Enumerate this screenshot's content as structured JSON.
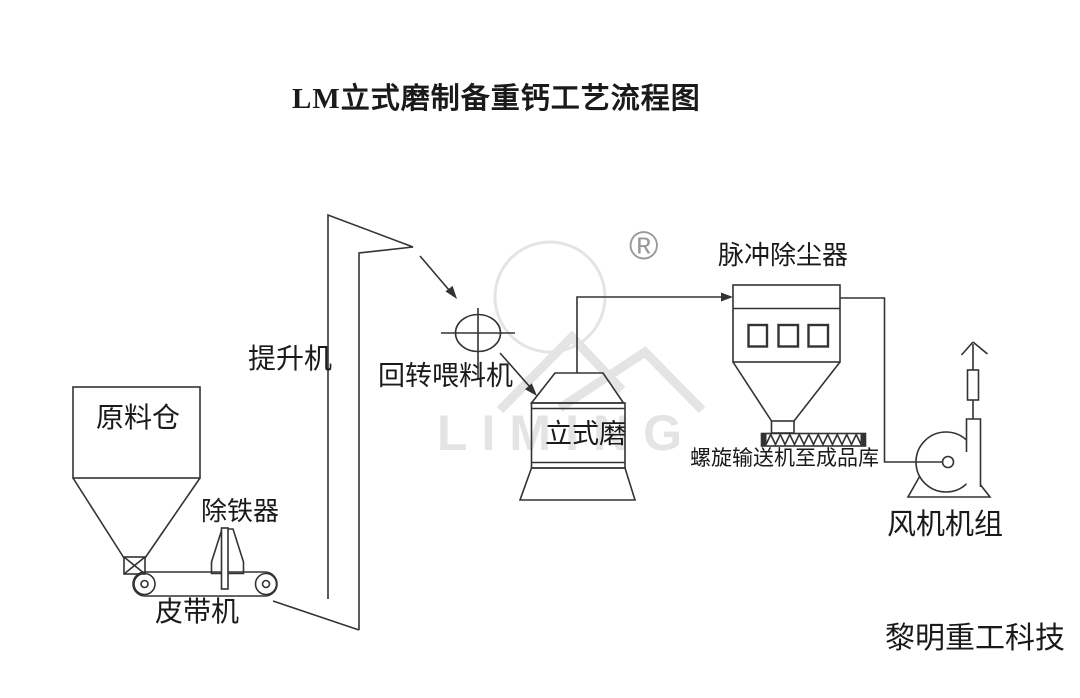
{
  "title": "LM立式磨制备重钙工艺流程图",
  "watermark": {
    "brand": "LIMING",
    "registered_mark": "®"
  },
  "labels": {
    "raw_material_silo": "原料仓",
    "iron_remover": "除铁器",
    "belt_conveyor": "皮带机",
    "bucket_elevator": "提升机",
    "rotary_feeder": "回转喂料机",
    "vertical_mill": "立式磨",
    "pulse_dust_collector": "脉冲除尘器",
    "screw_conveyor": "螺旋输送机至成品库",
    "fan_unit": "风机机组"
  },
  "footer": {
    "company": "黎明重工科技"
  },
  "colors": {
    "line": "#333333",
    "text": "#1a1a1a",
    "watermark_light": "#e4e4e4",
    "watermark_dark": "#999999",
    "background": "#ffffff"
  }
}
